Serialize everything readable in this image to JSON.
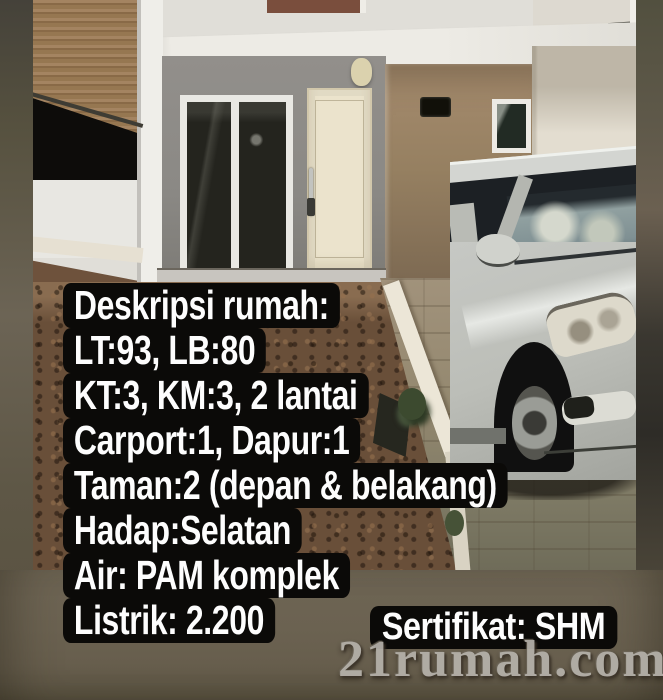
{
  "overlay": {
    "description_lines": [
      "Deskripsi rumah:",
      "LT:93, LB:80",
      "KT:3, KM:3, 2 lantai",
      "Carport:1, Dapur:1",
      "Taman:2 (depan & belakang)",
      "Hadap:Selatan",
      "Air: PAM komplek",
      "Listrik: 2.200"
    ],
    "certificate_label": "Sertifikat: SHM",
    "watermark": "21rumah.com"
  },
  "colors": {
    "overlay_box_bg": "#0b0a08",
    "overlay_text": "#fdfdfd",
    "watermark_text": "#b6b2ab",
    "background_olive": "#6b6251",
    "car_silver": "#c6c8c4",
    "house_wall_gray": "#8b8985",
    "house_panel_brown": "#97805f",
    "door_cream": "#ebe3cb",
    "garden_dirt": "#6a4f38",
    "paving": "#94886e",
    "curb_white": "#ece6d6",
    "rattan_fence": "#9b7b58"
  }
}
